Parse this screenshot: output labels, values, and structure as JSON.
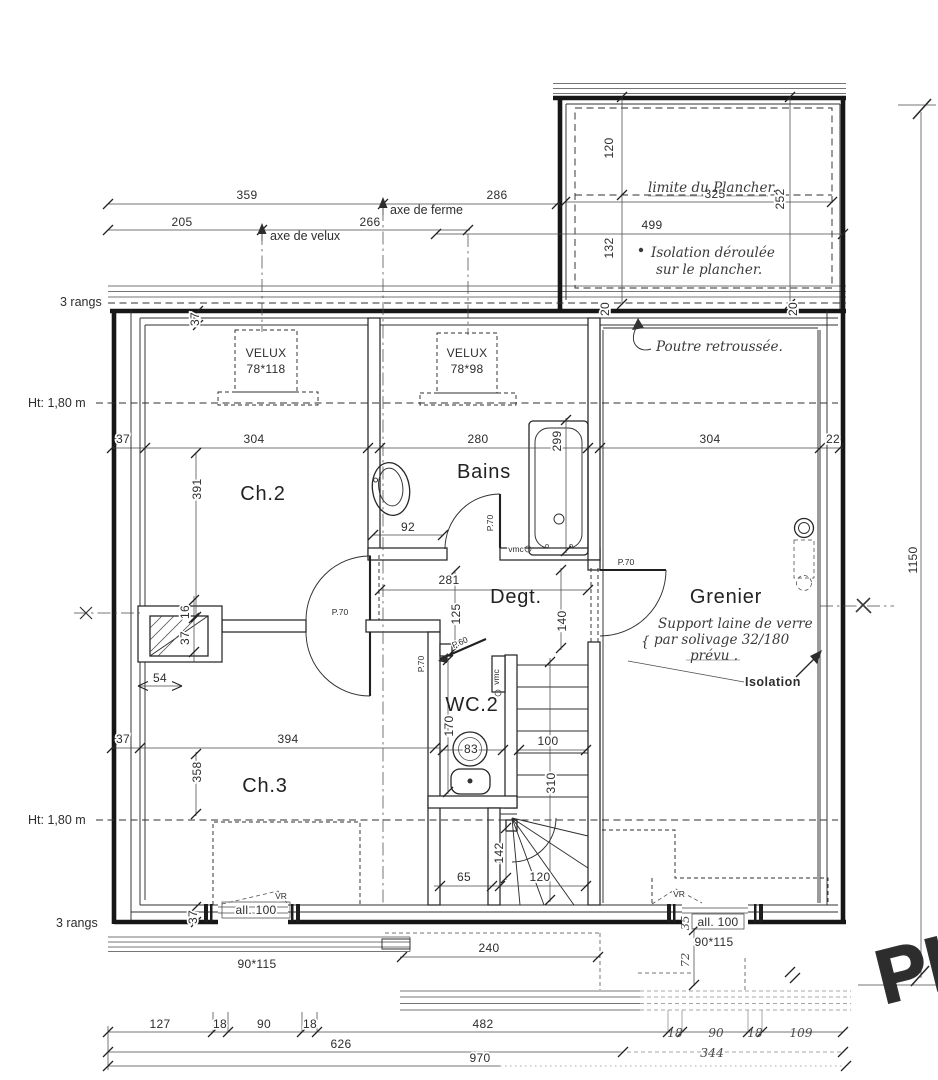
{
  "plan": {
    "corner_sketch": "PL",
    "annotations": {
      "rangs_top": "3 rangs",
      "rangs_bottom": "3 rangs",
      "ht_top": "Ht: 1,80 m",
      "ht_bottom": "Ht: 1,80 m",
      "axe_ferme": "axe de ferme",
      "axe_velux": "axe de velux",
      "limite_plancher": "limite du Plancher.",
      "isolation_deroulee_1": "Isolation déroulée",
      "isolation_deroulee_2": "sur le plancher.",
      "poutre_retroussee": "Poutre retroussée.",
      "support_1": "Support laine de verre",
      "support_2": "par solivage 32/180",
      "support_3": "prévu .",
      "support_brace": "{",
      "isolation_wall": "Isolation"
    },
    "rooms": {
      "ch2": "Ch.2",
      "bains": "Bains",
      "degt": "Degt.",
      "grenier": "Grenier",
      "wc2": "WC.2",
      "ch3": "Ch.3"
    },
    "equipment": {
      "velux1_name": "VELUX",
      "velux1_size": "78*118",
      "velux2_name": "VELUX",
      "velux2_size": "78*98",
      "vmc_bains": "vmc",
      "vmc_wc": "vmc",
      "door_bains": "P.70",
      "door_ch2": "P.70",
      "door_ch3": "P.70",
      "door_grenier": "P.70",
      "door_wc": "P.60",
      "vr_left": "VR",
      "vr_right": "VR",
      "allege_left": "all. 100",
      "allege_right": "all. 100",
      "window_left": "90*115",
      "window_right": "90*115"
    },
    "dims": {
      "top_359": "359",
      "top_286": "286",
      "top_205": "205",
      "top_266": "266",
      "annex_120": "120",
      "annex_252": "252",
      "annex_325": "325",
      "annex_499": "499",
      "annex_132": "132",
      "annex_20a": "20",
      "annex_20b": "20",
      "row1_37": "37",
      "row1_304a": "304",
      "row1_280": "280",
      "row1_299": "299",
      "row1_304b": "304",
      "row1_22": "22",
      "ch2_391": "391",
      "bains_92": "92",
      "degt_281": "281",
      "degt_125": "125",
      "degt_140": "140",
      "chimney_16": "16",
      "chimney_37": "37",
      "chimney_54": "54",
      "row2_37": "37",
      "row2_394": "394",
      "ch3_358": "358",
      "wc_170": "170",
      "wc_83": "83",
      "stair_100": "100",
      "stair_310": "310",
      "stair_142": "142",
      "stair_120": "120",
      "closet_65": "65",
      "bottom_240": "240",
      "wall_37_top": "37",
      "wall_37_bottom": "37",
      "right_1150": "1150",
      "chain1_127": "127",
      "chain1_18a": "18",
      "chain1_90a": "90",
      "chain1_18b": "18",
      "chain1_482": "482",
      "chain1_18c": "18",
      "chain1_90b": "90",
      "chain1_18d": "18",
      "chain1_109": "109",
      "chain2_626": "626",
      "chain2_344": "344",
      "chain3_970": "970",
      "win_35": "35",
      "win_72": "72"
    }
  }
}
